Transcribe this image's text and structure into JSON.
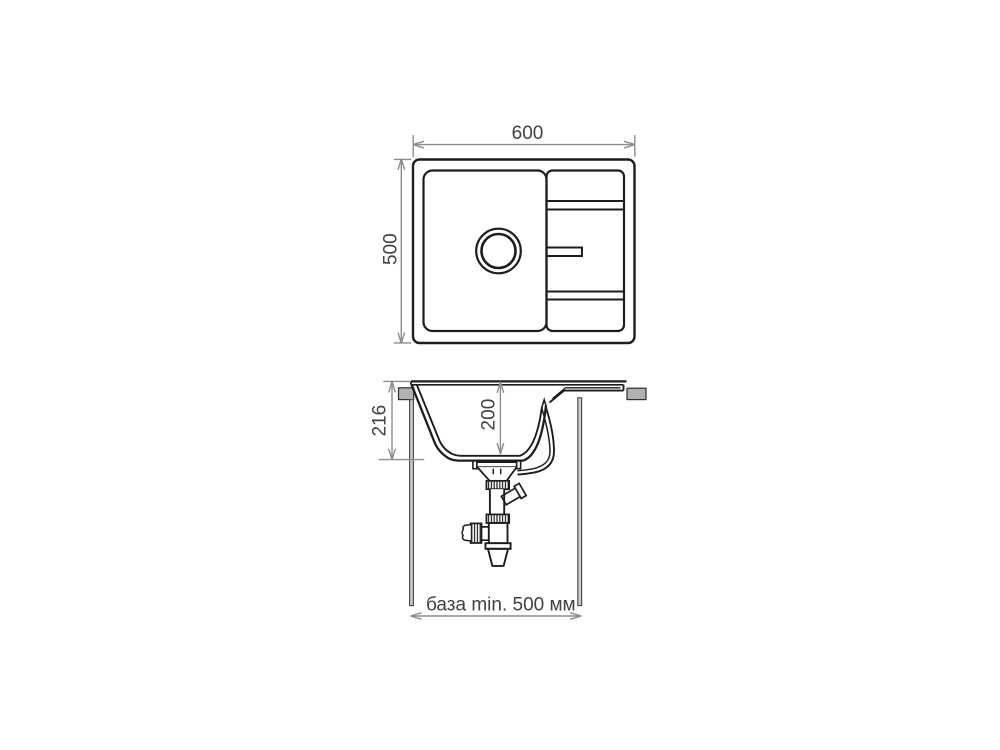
{
  "diagram": {
    "top_view": {
      "width_label": "600",
      "depth_label": "500"
    },
    "side_view": {
      "height_label": "216",
      "bowl_depth_label": "200",
      "base_label": "база min. 500 мм"
    },
    "colors": {
      "outline": "#1d1d1d",
      "dimension_line": "#8c8c8c",
      "dimension_text": "#414141",
      "countertop_fill": "#b2b2b2",
      "cabinet_wall_fill": "#cbcbcb",
      "background": "#ffffff"
    }
  }
}
